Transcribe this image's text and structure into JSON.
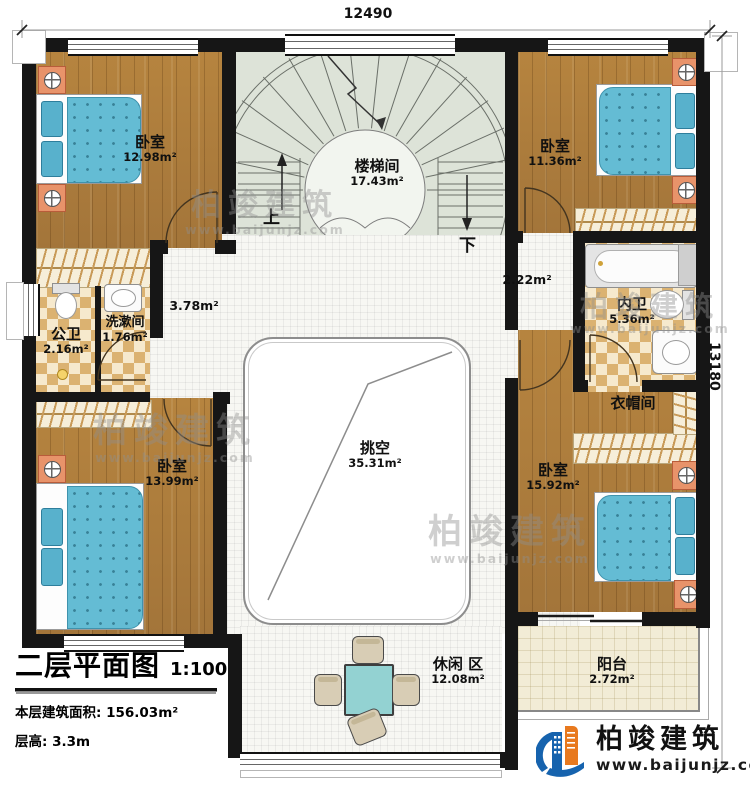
{
  "dimensions": {
    "width": "12490",
    "height": "13180"
  },
  "rooms": [
    {
      "id": "bedroom-tl",
      "name": "卧室",
      "area": "12.98m²"
    },
    {
      "id": "stairwell",
      "name": "楼梯间",
      "area": "17.43m²"
    },
    {
      "id": "bedroom-tr",
      "name": "卧室",
      "area": "11.36m²"
    },
    {
      "id": "public-bath",
      "name": "公卫",
      "area": "2.16m²"
    },
    {
      "id": "washroom",
      "name": "洗漱间",
      "area": "1.76m²"
    },
    {
      "id": "hall-left",
      "name": "",
      "area": "3.78m²"
    },
    {
      "id": "hall-right",
      "name": "",
      "area": "2.22m²"
    },
    {
      "id": "inner-bath",
      "name": "内卫",
      "area": "5.36m²"
    },
    {
      "id": "cloakroom",
      "name": "衣帽间",
      "area": ""
    },
    {
      "id": "bedroom-bl",
      "name": "卧室",
      "area": "13.99m²"
    },
    {
      "id": "void",
      "name": "挑空",
      "area": "35.31m²"
    },
    {
      "id": "bedroom-br",
      "name": "卧室",
      "area": "15.92m²"
    },
    {
      "id": "leisure",
      "name": "休闲 区",
      "area": "12.08m²"
    },
    {
      "id": "balcony",
      "name": "阳台",
      "area": "2.72m²"
    }
  ],
  "stairs": {
    "up_label": "上",
    "down_label": "下"
  },
  "title_block": {
    "title": "二层平面图",
    "scale": "1:100",
    "floor_area": "本层建筑面积: 156.03m²",
    "floor_height": "层高: 3.3m"
  },
  "brand": {
    "name": "柏竣建筑",
    "website": "www.baijunjz.com"
  },
  "watermark": {
    "name": "柏竣建筑",
    "website": "www.baijunjz.com"
  },
  "colors": {
    "wall": "#161616",
    "wood_floor": "#ab7c3b",
    "tile_checker": "#dbb271",
    "bed_blue": "#64bcd4",
    "stair_green": "#dde3d8",
    "logo_blue": "#1663ae",
    "logo_orange": "#e8791e"
  }
}
